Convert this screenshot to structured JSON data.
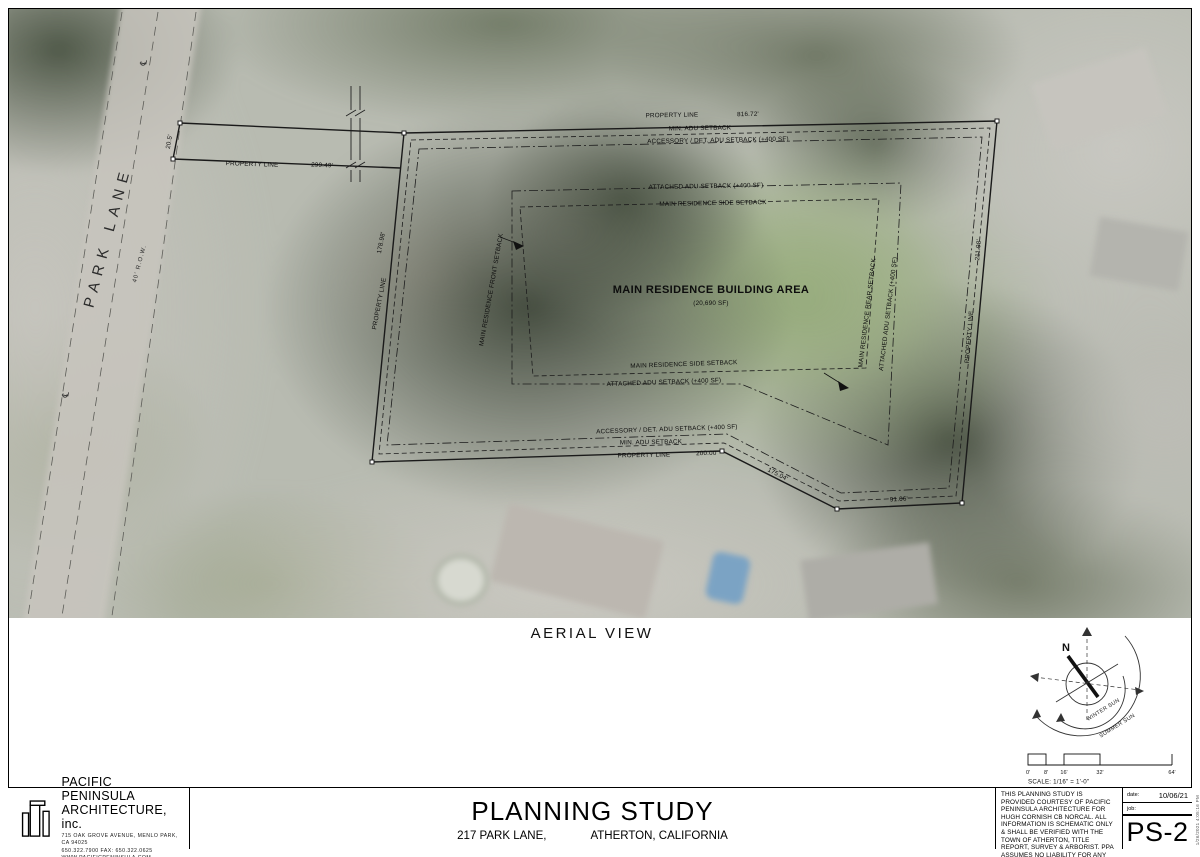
{
  "sheet": {
    "view_title": "AERIAL VIEW",
    "title": "PLANNING STUDY",
    "subtitle_address": "217 PARK LANE,",
    "subtitle_city": "ATHERTON, CALIFORNIA",
    "sheet_number": "PS-2",
    "date_label": "date:",
    "date_value": "10/06/21",
    "job_label": "job:",
    "plot_timestamp": "1/26/2021 4:05:16 PM",
    "notes": "THIS PLANNING STUDY IS PROVIDED COURTESY OF PACIFIC PENINSULA ARCHITECTURE FOR HUGH CORNISH CB NORCAL. ALL INFORMATION IS SCHEMATIC ONLY & SHALL BE VERIFIED WITH THE TOWN OF ATHERTON, TITLE REPORT, SURVEY & ARBORIST. PPA ASSUMES NO LIABILITY FOR ANY WORK THAT IS BASED UPON THE INFORMATION WITHIN THESE DRAWINGS."
  },
  "firm": {
    "name_line1": "PACIFIC PENINSULA",
    "name_line2": "ARCHITECTURE, inc.",
    "address": "715 OAK GROVE AVENUE, MENLO PARK, CA 94025",
    "phone": "650.322.7900 FAX: 650.322.0625",
    "website": "WWW.PACIFICPENINSULA.COM"
  },
  "plan": {
    "street_name": "PARK LANE",
    "row_label": "40' R.O.W.",
    "centerline_symbol": "℄",
    "property_line_label": "PROPERTY LINE",
    "building_area_title": "MAIN RESIDENCE BUILDING AREA",
    "building_area_sf": "(20,690 SF)",
    "dims": {
      "north": "816.72'",
      "strip": "299.49'",
      "south": "200.00'",
      "west": "178.98'",
      "east": "211.98'",
      "strip_width": "20.5'",
      "south_diag": "175.04'",
      "south_east": "91.06'"
    },
    "setbacks": {
      "min_adu": "MIN. ADU SETBACK",
      "accessory": "ACCESSORY / DET. ADU SETBACK (+400 SF)",
      "attached": "ATTACHED ADU SETBACK (+400 SF)",
      "side": "MAIN RESIDENCE SIDE SETBACK",
      "front": "MAIN RESIDENCE FRONT SETBACK",
      "rear": "MAIN RESIDENCE REAR SETBACK"
    }
  },
  "compass": {
    "north_label": "N",
    "winter": "WINTER SUN",
    "summer": "SUMMER SUN"
  },
  "scale_bar": {
    "ticks": [
      "0'",
      "8'",
      "16'",
      "32'",
      "64'"
    ],
    "caption": "SCALE: 1/16\" = 1'-0\""
  }
}
